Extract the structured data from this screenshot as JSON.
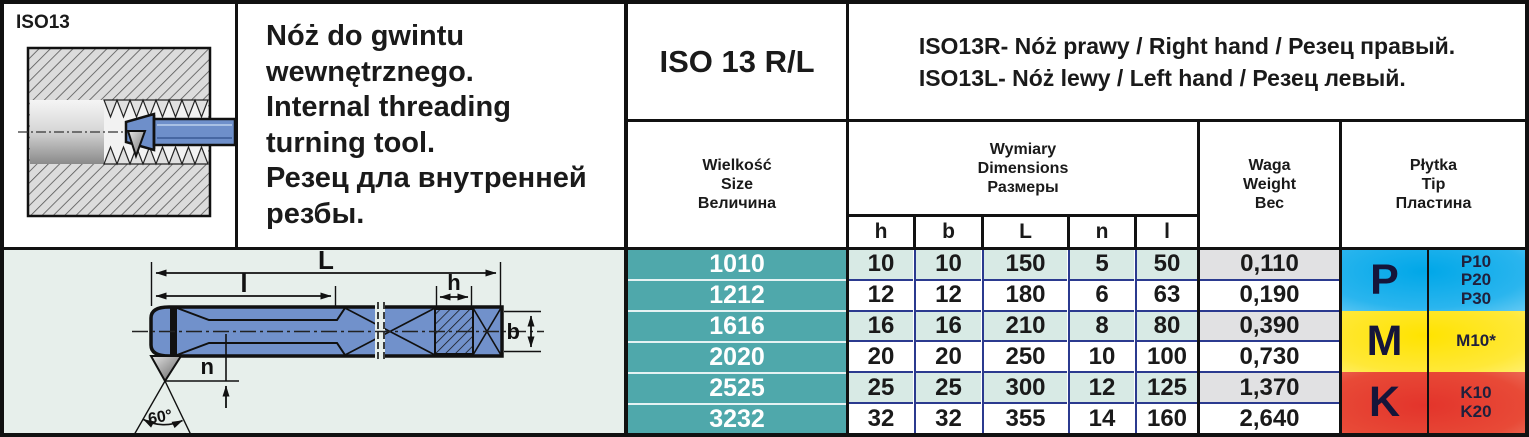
{
  "product": {
    "code_label": "ISO13",
    "title": "ISO 13 R/L",
    "description_lines": [
      "Nóż do gwintu",
      "wewnętrznego.",
      "Internal threading",
      "turning tool.",
      "Резец дла внутренней",
      "резбы."
    ],
    "variant_right": "ISO13R- Nóż prawy / Right hand / Резец правый.",
    "variant_left": "ISO13L- Nóż lewy / Left hand / Резец левый."
  },
  "table": {
    "size_header": [
      "Wielkość",
      "Size",
      "Величина"
    ],
    "dims_header": [
      "Wymiary",
      "Dimensions",
      "Размеры"
    ],
    "dim_cols": [
      "h",
      "b",
      "L",
      "n",
      "l"
    ],
    "weight_header": [
      "Waga",
      "Weight",
      "Вес"
    ],
    "tip_header": [
      "Płytka",
      "Tip",
      "Пластина"
    ],
    "rows": [
      {
        "size": "1010",
        "h": "10",
        "b": "10",
        "L": "150",
        "n": "5",
        "l": "50",
        "weight": "0,110"
      },
      {
        "size": "1212",
        "h": "12",
        "b": "12",
        "L": "180",
        "n": "6",
        "l": "63",
        "weight": "0,190"
      },
      {
        "size": "1616",
        "h": "16",
        "b": "16",
        "L": "210",
        "n": "8",
        "l": "80",
        "weight": "0,390"
      },
      {
        "size": "2020",
        "h": "20",
        "b": "20",
        "L": "250",
        "n": "10",
        "l": "100",
        "weight": "0,730"
      },
      {
        "size": "2525",
        "h": "25",
        "b": "25",
        "L": "300",
        "n": "12",
        "l": "125",
        "weight": "1,370"
      },
      {
        "size": "3232",
        "h": "32",
        "b": "32",
        "L": "355",
        "n": "14",
        "l": "160",
        "weight": "2,640"
      }
    ]
  },
  "grades": {
    "p": {
      "letter": "P",
      "lines": [
        "P10",
        "P20",
        "P30"
      ]
    },
    "m": {
      "letter": "M",
      "lines": [
        "M10*"
      ]
    },
    "k": {
      "letter": "K",
      "lines": [
        "K10",
        "K20"
      ]
    }
  },
  "drawing": {
    "dim_L": "L",
    "dim_l": "l",
    "dim_h": "h",
    "dim_b": "b",
    "dim_n": "n",
    "angle": "60°"
  },
  "colors": {
    "size_column_teal": "#4FA8AB",
    "row_tint_teal": "#D8EAE5",
    "row_tint_gray": "#E1E1E3",
    "grade_p_blue": "#00A7E8",
    "grade_m_yellow": "#FFE300",
    "grade_k_red": "#E3342B",
    "tool_blue": "#7191CB",
    "separator_navy": "#2B3A8F"
  }
}
